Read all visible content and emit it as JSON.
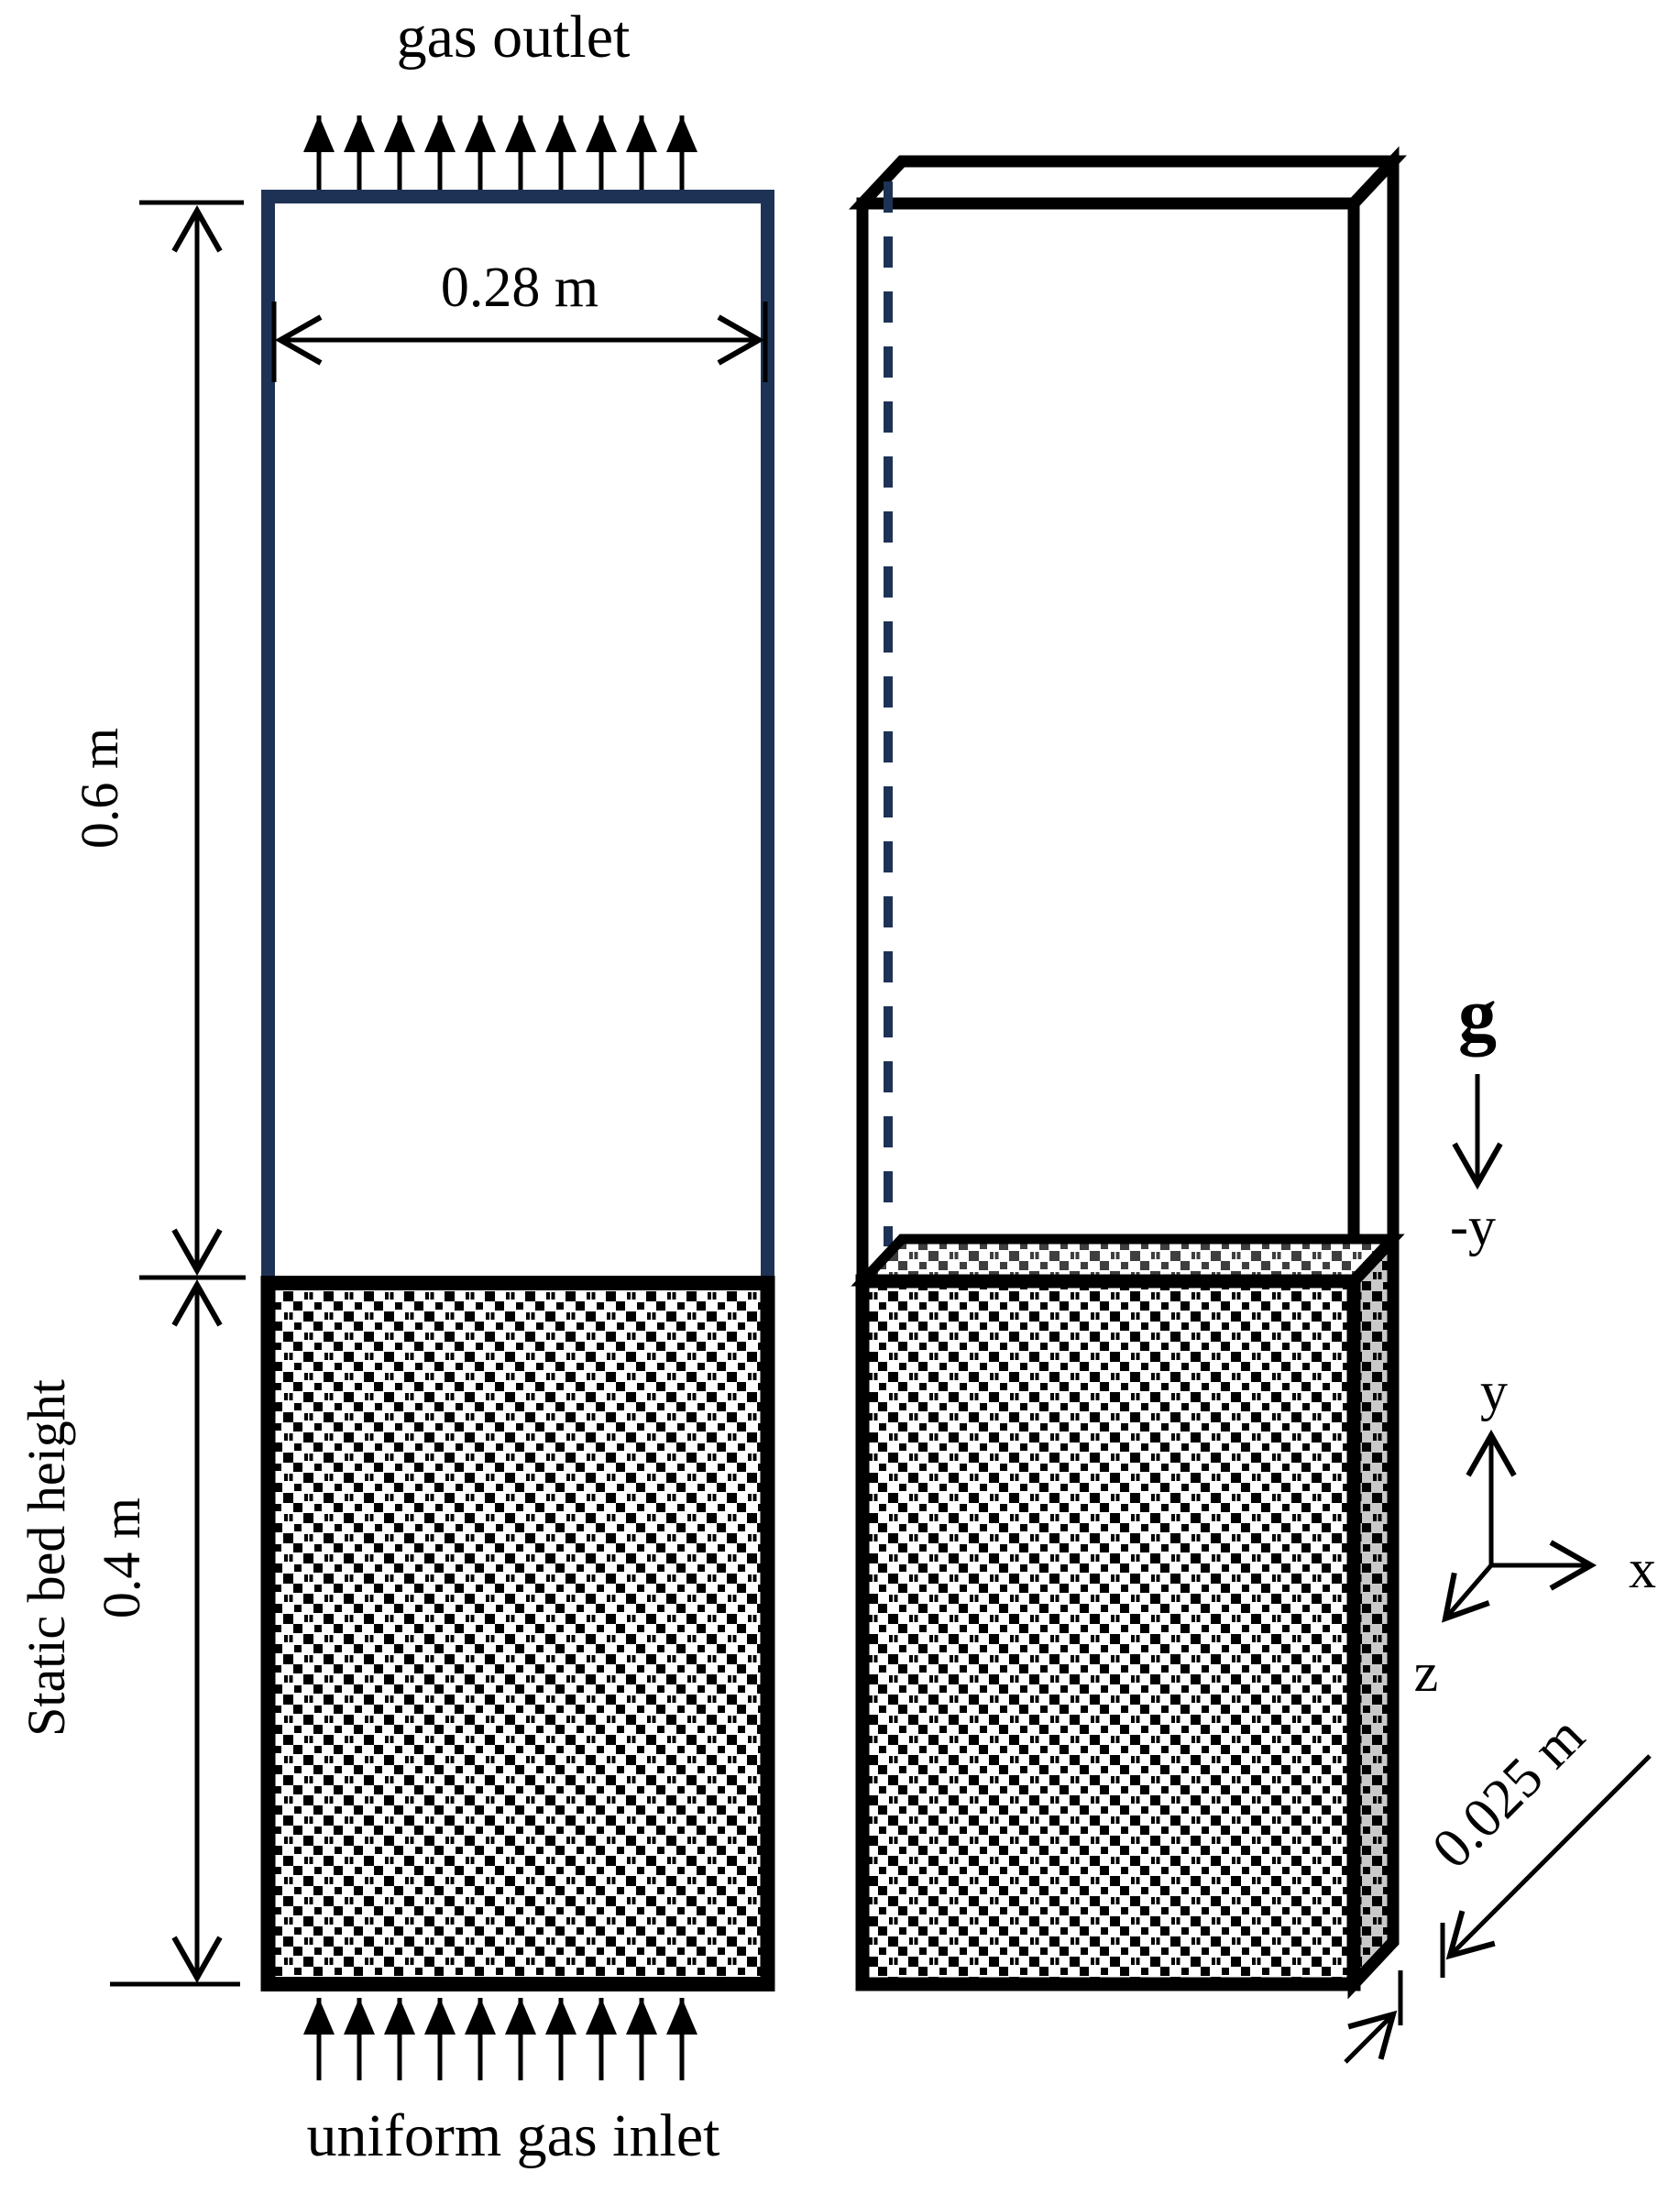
{
  "labels": {
    "gas_outlet": "gas outlet",
    "gas_inlet": "uniform gas inlet",
    "column_width": "0.28 m",
    "freeboard_height": "0.6 m",
    "static_bed_line1": "Static bed height",
    "static_bed_line2": "0.4 m",
    "depth": "0.025 m",
    "gravity": "g",
    "gravity_direction": "-y",
    "axis_x": "x",
    "axis_y": "y",
    "axis_z": "z"
  },
  "colors": {
    "column_outline_navy": "#1e3255",
    "outline_black": "#000000",
    "bed_pattern_squares": "#000000",
    "bed_top_surface_squares": "#3f3f3f",
    "side_face_bed_background": "#c9c9c9",
    "background": "#ffffff"
  }
}
